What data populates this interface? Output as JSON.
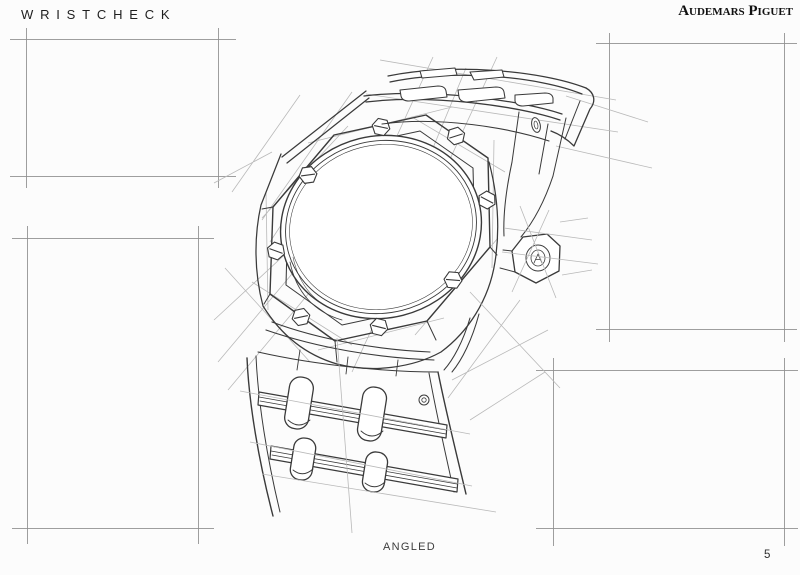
{
  "header": {
    "brand_left": "WRISTCHECK",
    "brand_right": "Audemars Piguet"
  },
  "footer": {
    "caption": "ANGLED",
    "page_number": "5"
  },
  "sketch": {
    "name": "royal-oak-watch-angled-pencil-sketch",
    "view_label": "ANGLED"
  },
  "frames": [
    {
      "name": "frame-top-left"
    },
    {
      "name": "frame-middle-left"
    },
    {
      "name": "frame-top-right"
    },
    {
      "name": "frame-bottom-right"
    }
  ],
  "colors": {
    "ink": "#3a3a3a",
    "construction": "#b9b9b9",
    "frame_line": "#8d8d8d",
    "paper": "#fcfcfc"
  }
}
